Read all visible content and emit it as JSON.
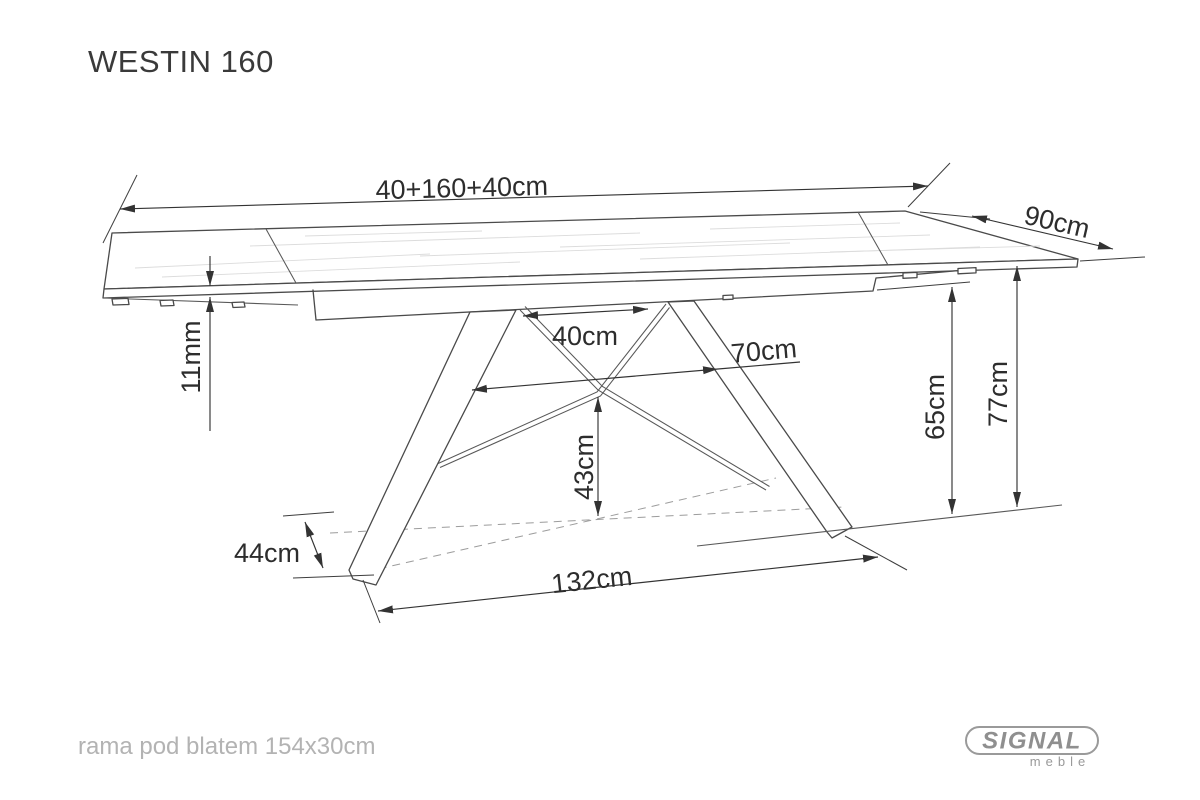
{
  "title": "WESTIN 160",
  "drawing": {
    "dimensions": {
      "top_width": "40+160+40cm",
      "depth": "90cm",
      "top_thickness": "11mm",
      "frame_top_spread": "40cm",
      "frame_mid_spread": "70cm",
      "underframe_height": "65cm",
      "table_height": "77cm",
      "frame_node_height": "43cm",
      "foot_length": "44cm",
      "base_span": "132cm"
    }
  },
  "footer": {
    "note": "rama pod blatem 154x30cm"
  },
  "logo": {
    "brand": "SIGNAL",
    "subbrand": "meble"
  }
}
